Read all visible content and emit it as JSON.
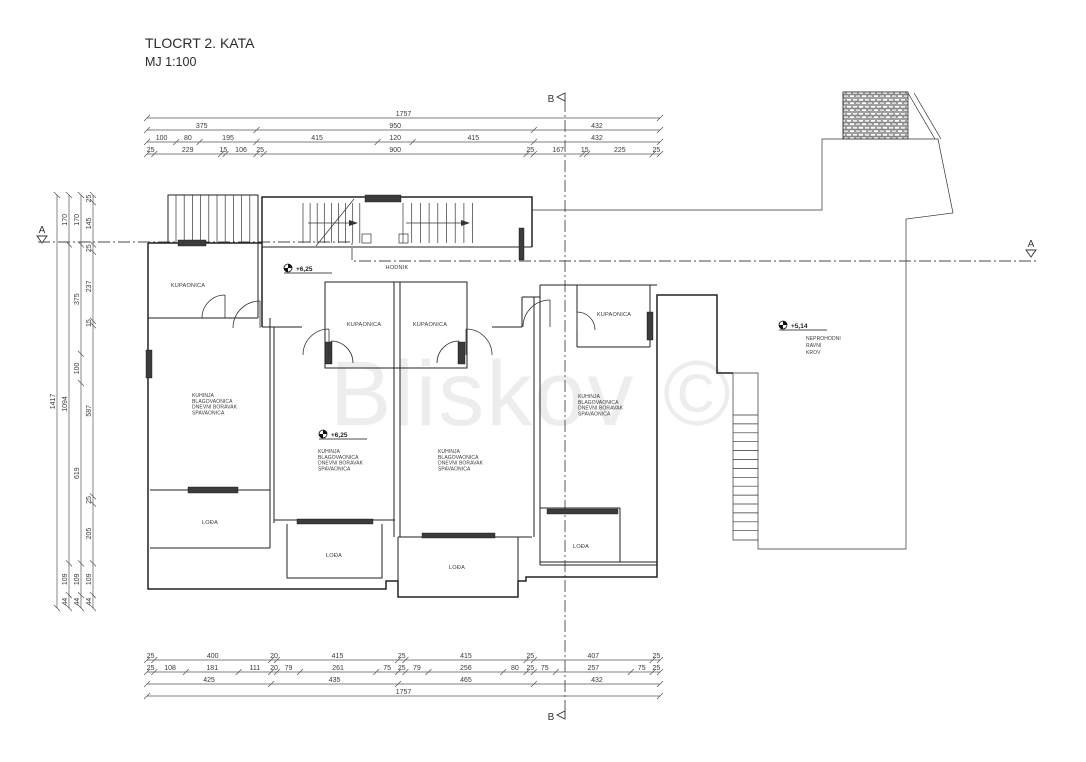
{
  "title": {
    "line1": "TLOCRT 2. KATA",
    "line2": "MJ 1:100"
  },
  "watermark": "Bliskov ©",
  "section_markers": {
    "a": "A",
    "b": "B"
  },
  "room_labels": [
    {
      "name": "hodnik",
      "text": "HODNIK",
      "x": 397,
      "y": 269
    },
    {
      "name": "kupaonica-1",
      "text": "KUPAONICA",
      "x": 188,
      "y": 287
    },
    {
      "name": "kupaonica-2",
      "text": "KUPAONICA",
      "x": 364,
      "y": 326
    },
    {
      "name": "kupaonica-3",
      "text": "KUPAONICA",
      "x": 430,
      "y": 326
    },
    {
      "name": "kupaonica-4",
      "text": "KUPAONICA",
      "x": 614,
      "y": 316
    },
    {
      "name": "loda-1",
      "text": "LOĐA",
      "x": 210,
      "y": 524
    },
    {
      "name": "loda-2",
      "text": "LOĐA",
      "x": 334,
      "y": 557
    },
    {
      "name": "loda-3",
      "text": "LOĐA",
      "x": 457,
      "y": 569
    },
    {
      "name": "loda-4",
      "text": "LOĐA",
      "x": 581,
      "y": 548
    }
  ],
  "unit_labels": [
    {
      "x": 192,
      "y": 397,
      "lines": [
        "KUHINJA",
        "BLAGOVAONICA",
        "DNEVNI BORAVAK",
        "SPAVAONICA"
      ]
    },
    {
      "x": 318,
      "y": 453,
      "lines": [
        "KUHINJA",
        "BLAGOVAONICA",
        "DNEVNI BORAVAK",
        "SPAVAONICA"
      ]
    },
    {
      "x": 438,
      "y": 453,
      "lines": [
        "KUHINJA",
        "BLAGOVAONICA",
        "DNEVNI BORAVAK",
        "SPAVAONICA"
      ]
    },
    {
      "x": 578,
      "y": 398,
      "lines": [
        "KUHINJA",
        "BLAGOVAONICA",
        "DNEVNI BORAVAK",
        "SPAVAONICA"
      ]
    }
  ],
  "roof_label": {
    "x": 806,
    "y": 340,
    "lines": [
      "NEPROHODNI",
      "RAVNI",
      "KROV"
    ]
  },
  "elevations": [
    {
      "text": "+6,25",
      "x": 296,
      "y": 271,
      "mx": 288,
      "my": 268
    },
    {
      "text": "+6,25",
      "x": 331,
      "y": 437,
      "mx": 323,
      "my": 434
    },
    {
      "text": "+5,14",
      "x": 791,
      "y": 328,
      "mx": 783,
      "my": 325
    }
  ],
  "dim_chains": {
    "top": {
      "x0": 147,
      "x1": 660,
      "rows": [
        {
          "y": 118,
          "segments": [
            1757
          ]
        },
        {
          "y": 130,
          "segments": [
            375,
            950,
            432
          ]
        },
        {
          "y": 142,
          "segments": [
            100,
            80,
            195,
            415,
            120,
            415,
            432
          ]
        },
        {
          "y": 154,
          "segments": [
            25,
            229,
            15,
            106,
            25,
            900,
            25,
            167,
            15,
            225,
            25
          ]
        }
      ]
    },
    "bottom": {
      "x0": 147,
      "x1": 660,
      "rows": [
        {
          "y": 660,
          "segments": [
            25,
            400,
            20,
            415,
            25,
            415,
            25,
            407,
            25
          ]
        },
        {
          "y": 672,
          "segments": [
            25,
            108,
            181,
            111,
            20,
            79,
            261,
            75,
            25,
            79,
            256,
            80,
            25,
            75,
            257,
            75,
            25
          ]
        },
        {
          "y": 684,
          "segments": [
            425,
            435,
            465,
            432
          ]
        },
        {
          "y": 696,
          "segments": [
            1757
          ]
        }
      ]
    },
    "left": {
      "y0": 195,
      "y1": 608,
      "cols": [
        {
          "x": 57,
          "segments": [
            1417
          ]
        },
        {
          "x": 69,
          "segments": [
            170,
            1094,
            109,
            44
          ]
        },
        {
          "x": 81,
          "segments": [
            170,
            375,
            100,
            619,
            109,
            44
          ]
        },
        {
          "x": 93,
          "segments": [
            25,
            145,
            25,
            237,
            15,
            587,
            25,
            205,
            109,
            44
          ]
        }
      ]
    }
  }
}
